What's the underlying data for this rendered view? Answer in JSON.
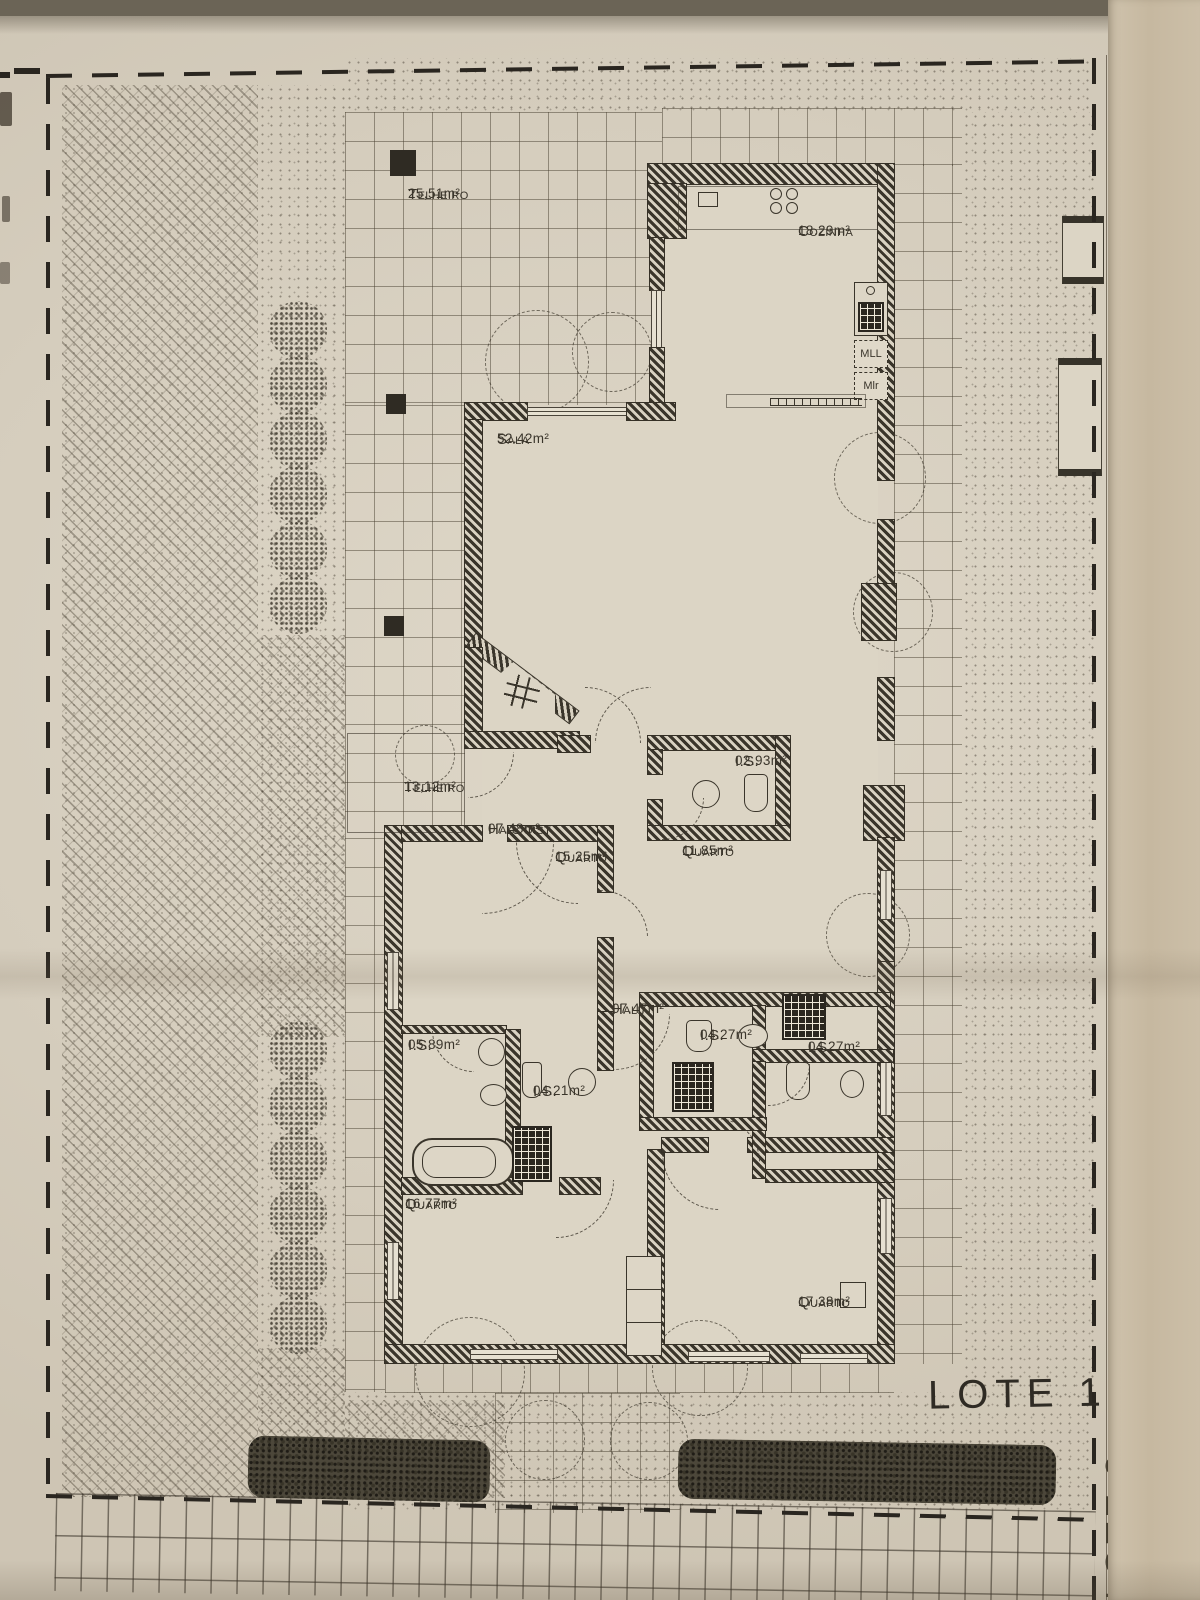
{
  "plan": {
    "rooms": [
      {
        "name": "Telheiro",
        "area": "25,51m²"
      },
      {
        "name": "Cozinha",
        "area": "18.29m²"
      },
      {
        "name": "Sala",
        "area": "52.42m²"
      },
      {
        "name": "Telheiro",
        "area": "13,12m²"
      },
      {
        "name": "Hall dist.",
        "area": "07.48m²"
      },
      {
        "name": "Quarto",
        "area": "15.25m²"
      },
      {
        "name": "I.S.",
        "area": "02.93m²"
      },
      {
        "name": "Quarto",
        "area": "11.85m²"
      },
      {
        "name": "Hall",
        "area": "07.47m²"
      },
      {
        "name": "I.S.",
        "area": "05.89m²"
      },
      {
        "name": "I.S.",
        "area": "04.21m²"
      },
      {
        "name": "I.S.",
        "area": "04.27m²"
      },
      {
        "name": "I.S.",
        "area": "04.27m²"
      },
      {
        "name": "Quarto",
        "area": "16.77m²"
      },
      {
        "name": "Quarto",
        "area": "17.38m²"
      }
    ],
    "appliances": {
      "mll": "MLL",
      "mlr": "Mlr"
    },
    "lot_label": "LOTE 1",
    "adjacent_lot_label": "LOTE 2"
  },
  "colors": {
    "paper": "#d8d1c2",
    "ink": "#3a352b",
    "wall": "#2f2b23",
    "fold_band": "#c8baa3"
  }
}
